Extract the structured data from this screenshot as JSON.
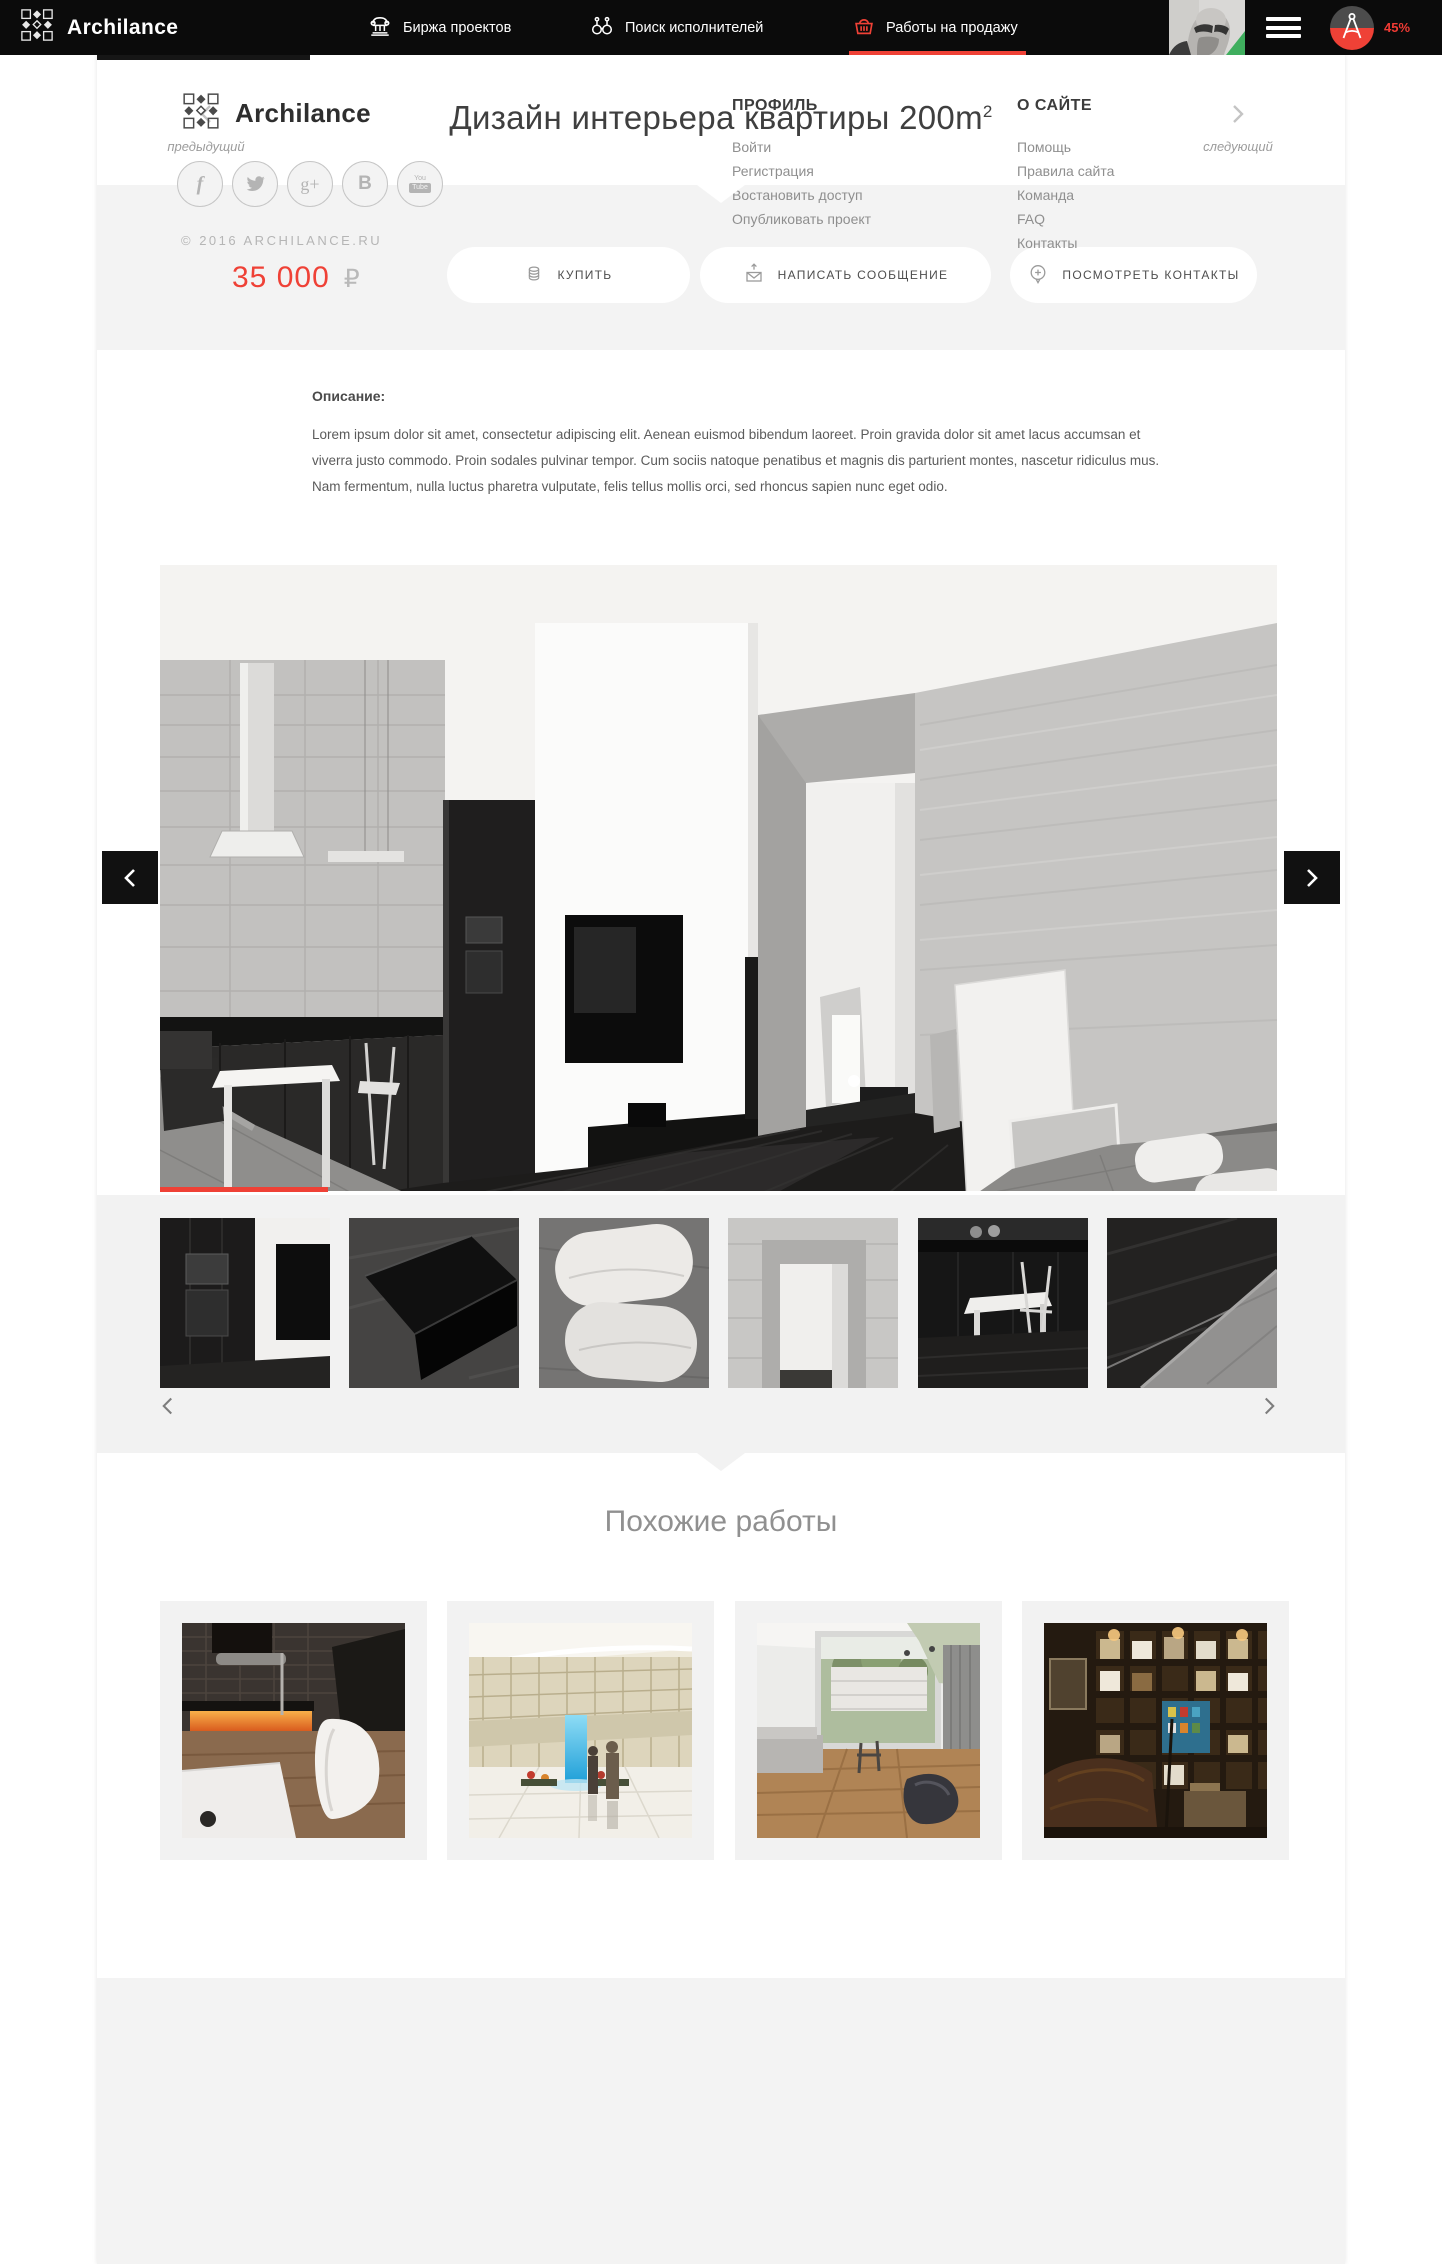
{
  "navbar": {
    "brand": "Archilance",
    "menu": [
      {
        "label": "Биржа проектов",
        "icon": "bank-column-icon"
      },
      {
        "label": "Поиск исполнителей",
        "icon": "binoculars-icon"
      },
      {
        "label": "Работы на продажу",
        "icon": "basket-icon",
        "active": true
      }
    ],
    "progress_badge": "45%"
  },
  "project": {
    "title": "Дизайн интерьера квартиры 200m",
    "title_superscript": "2",
    "prev_label": "предыдущий",
    "next_label": "следующий",
    "price_value": "35 000",
    "price_currency": "₽",
    "actions": {
      "buy": "КУПИТЬ",
      "message": "НАПИСАТЬ СООБЩЕНИЕ",
      "contacts": "ПОСМОТРЕТЬ КОНТАКТЫ"
    },
    "description_label": "Описание:",
    "description_text": "Lorem ipsum dolor sit amet, consectetur adipiscing elit. Aenean euismod bibendum laoreet. Proin gravida dolor sit amet lacus accumsan et viverra justo commodo. Proin sodales pulvinar tempor. Cum sociis natoque penatibus et magnis dis parturient montes, nascetur ridiculus mus. Nam fermentum, nulla luctus pharetra vulputate, felis tellus mollis orci, sed rhoncus sapien nunc eget odio."
  },
  "similar": {
    "heading": "Похожие работы"
  },
  "footer": {
    "brand": "Archilance",
    "copyright": "© 2016 ARCHILANCE.RU",
    "columns": [
      {
        "title": "ПРОФИЛЬ",
        "links": [
          "Войти",
          "Регистрация",
          "Востановить доступ",
          "Опубликовать проект"
        ]
      },
      {
        "title": "О САЙТЕ",
        "links": [
          "Помощь",
          "Правила сайта",
          "Команда",
          "FAQ",
          "Контакты"
        ]
      }
    ],
    "social": [
      {
        "name": "facebook",
        "glyph": "f"
      },
      {
        "name": "twitter",
        "glyph": ""
      },
      {
        "name": "google-plus",
        "glyph": "g+"
      },
      {
        "name": "vk",
        "glyph": "B"
      },
      {
        "name": "youtube",
        "glyph_top": "You",
        "glyph_bottom": "Tube"
      }
    ]
  },
  "colors": {
    "accent": "#ef4136",
    "navbar_bg": "#0b0b0b",
    "section_gray": "#f3f3f3"
  }
}
